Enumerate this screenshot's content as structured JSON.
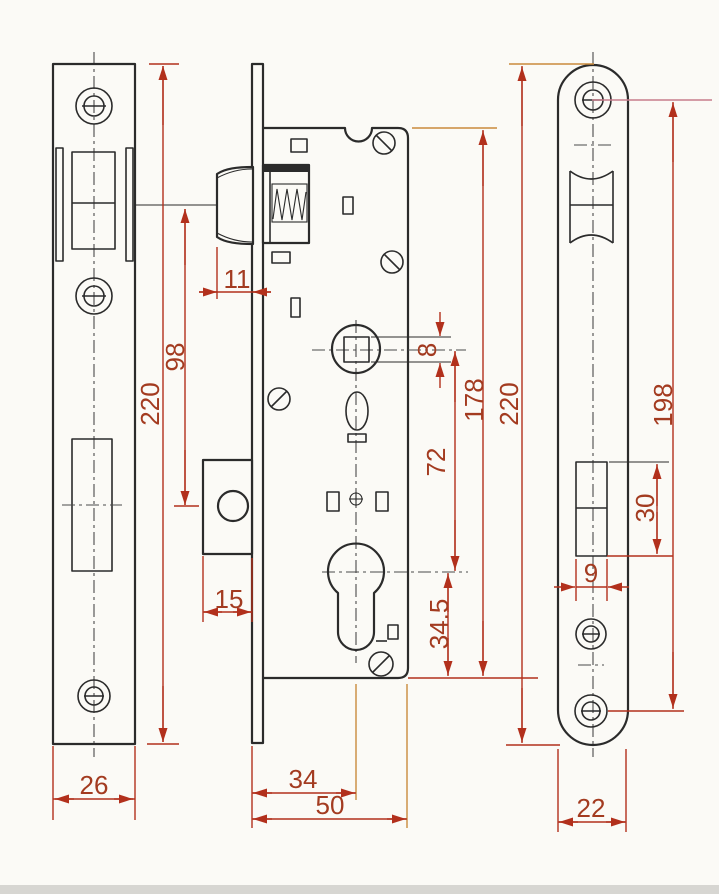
{
  "colors": {
    "line": "#2b2b2b",
    "dimension": "#b2301c",
    "dim-text": "#a33b20",
    "ext-orange": "#c98a3c",
    "ext-pink": "#c87c8c",
    "background": "#fbfaf6"
  },
  "dims": {
    "latch_projection": "11",
    "latch_to_deadbolt": "98",
    "strike_plate_height": "220",
    "spindle_square": "8",
    "spindle_to_cylinder": "72",
    "case_height": "178",
    "cylinder_to_case_bottom": "34.5",
    "deadbolt_throw": "15",
    "backset": "34",
    "case_depth": "50",
    "strike_plate_width": "26",
    "faceplate_height": "220",
    "screw_centers": "198",
    "deadbolt_cutout_height": "30",
    "deadbolt_cutout_width": "9",
    "faceplate_width": "22"
  }
}
